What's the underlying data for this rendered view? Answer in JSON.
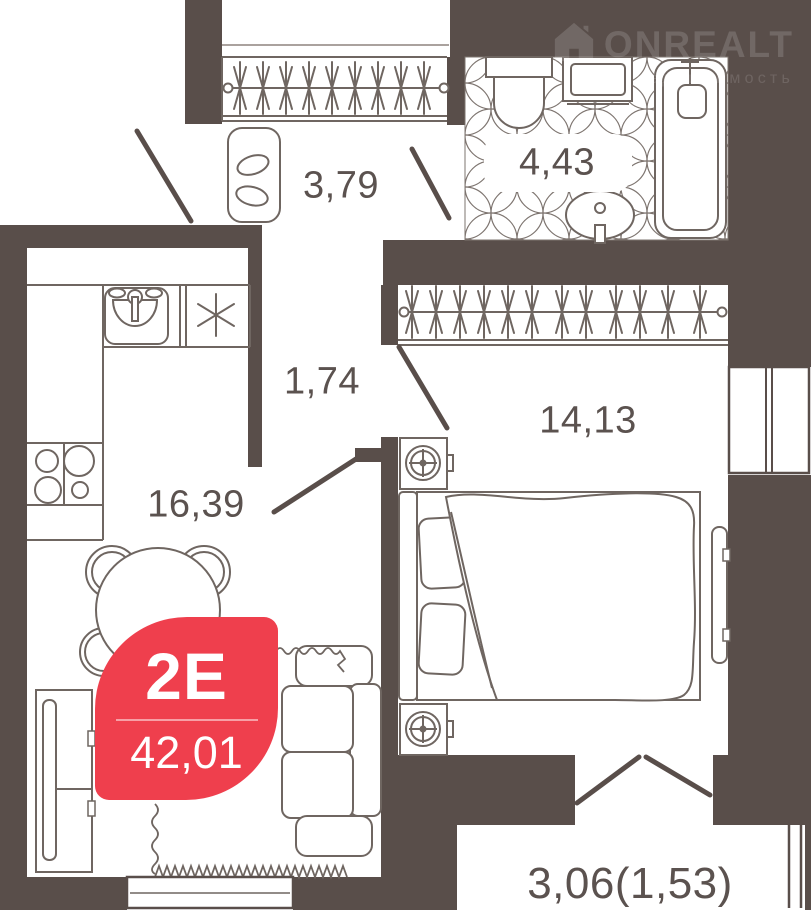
{
  "watermark": {
    "brand": "ONREALT",
    "subtitle": "недвижимость"
  },
  "badge": {
    "type": "2Е",
    "area": "42,01"
  },
  "rooms": {
    "hallway": {
      "name": "hallway",
      "area": "3,79"
    },
    "bathroom": {
      "name": "bathroom",
      "area": "4,43"
    },
    "corridor": {
      "name": "corridor",
      "area": "1,74"
    },
    "bedroom": {
      "name": "bedroom",
      "area": "14,13"
    },
    "living_kitchen": {
      "name": "kitchen-living",
      "area": "16,39"
    },
    "balcony": {
      "name": "balcony",
      "area": "3,06(1,53)"
    }
  },
  "colors": {
    "wall": "#594e4a",
    "accent_red": "#ef3f4d",
    "furniture_line": "#6f6661",
    "tile_line": "#7d746f",
    "label_text": "#5b524f"
  },
  "icons": {
    "logo": "house-icon"
  }
}
